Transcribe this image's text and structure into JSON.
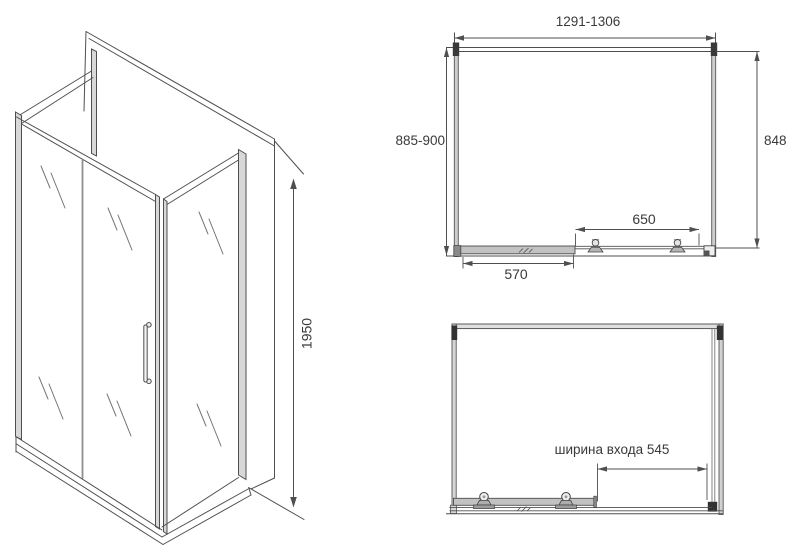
{
  "drawing": {
    "iso": {
      "height": "1950"
    },
    "plan": {
      "width_range": "1291-1306",
      "depth_range": "885-900",
      "inner_depth": "848",
      "opening_rail": "650",
      "fixed_panel": "570"
    },
    "front": {
      "entry_width": "ширина входа 545"
    }
  },
  "colors": {
    "background": "#ffffff",
    "line": "#4c4c4c",
    "text": "#3a3a3a"
  }
}
